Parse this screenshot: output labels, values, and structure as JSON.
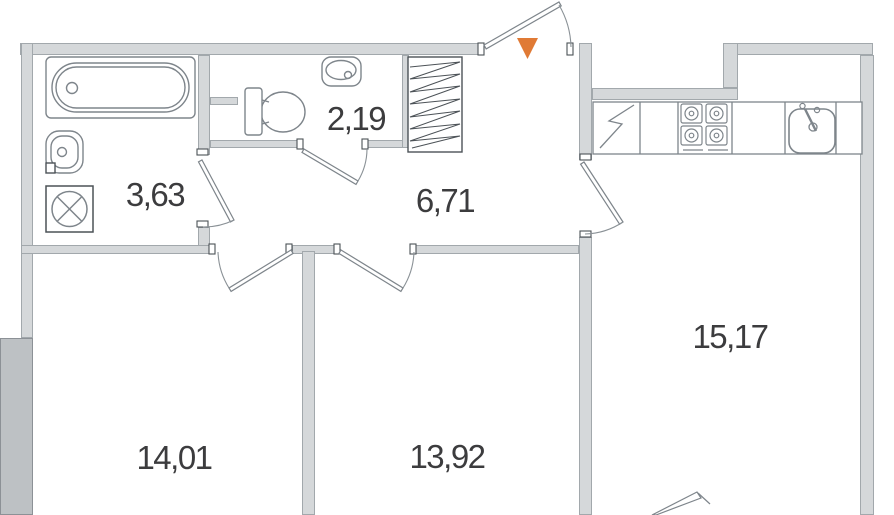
{
  "plan": {
    "rooms": [
      {
        "id": "bathroom",
        "area": "3,63"
      },
      {
        "id": "wc",
        "area": "2,19"
      },
      {
        "id": "hallway",
        "area": "6,71"
      },
      {
        "id": "room-1",
        "area": "14,01"
      },
      {
        "id": "room-2",
        "area": "13,92"
      },
      {
        "id": "kitchen-living-room",
        "area": "15,17"
      }
    ],
    "entrance": {
      "icon": "entrance-arrow-icon",
      "color": "#e07a35"
    },
    "colors": {
      "wall_fill": "#d5d8da",
      "wall_dark_fill": "#bdc1c4",
      "line": "#7e858b",
      "text": "#3c3c3e"
    }
  }
}
